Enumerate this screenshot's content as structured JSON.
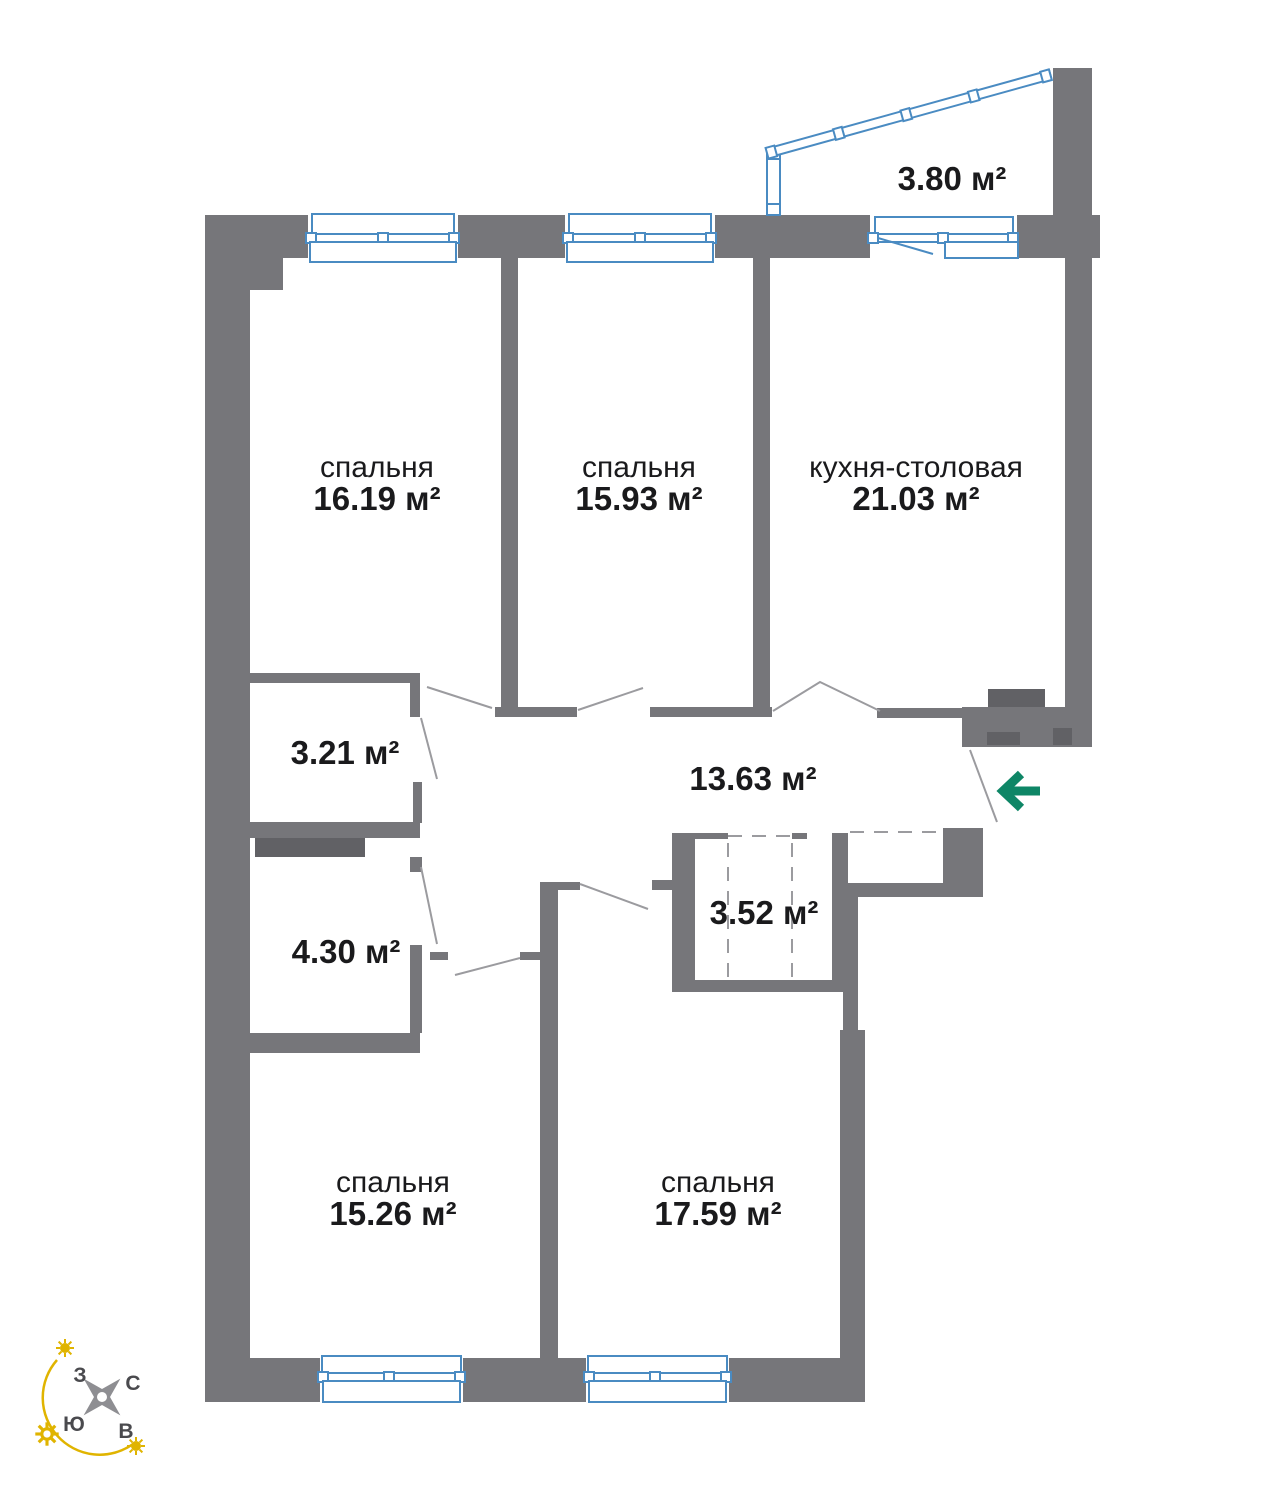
{
  "plan": {
    "title": "apartment floor plan",
    "rooms": [
      {
        "id": "bedroom-1",
        "name": "спальня",
        "area": "16.19 м²"
      },
      {
        "id": "bedroom-2",
        "name": "спальня",
        "area": "15.93 м²"
      },
      {
        "id": "kitchen-dining",
        "name": "кухня-столовая",
        "area": "21.03 м²"
      },
      {
        "id": "balcony",
        "name": "",
        "area": "3.80 м²"
      },
      {
        "id": "bathroom-1",
        "name": "",
        "area": "3.21 м²"
      },
      {
        "id": "hallway",
        "name": "",
        "area": "13.63 м²"
      },
      {
        "id": "bathroom-2",
        "name": "",
        "area": "4.30 м²"
      },
      {
        "id": "wardrobe",
        "name": "",
        "area": "3.52 м²"
      },
      {
        "id": "bedroom-3",
        "name": "спальня",
        "area": "15.26 м²"
      },
      {
        "id": "bedroom-4",
        "name": "спальня",
        "area": "17.59 м²"
      }
    ],
    "compass": {
      "north": "С",
      "east": "В",
      "south": "Ю",
      "west": "З"
    },
    "colors": {
      "wall": "#76767a",
      "wall_dark": "#616165",
      "window": "#4a8bc2",
      "door_line": "#9b9b9f",
      "entry_arrow": "#0e8666",
      "compass_star": "#8e8e92",
      "compass_sun": "#e0b400",
      "compass_text": "#4a4a4e",
      "text": "#1a1a1c"
    }
  }
}
